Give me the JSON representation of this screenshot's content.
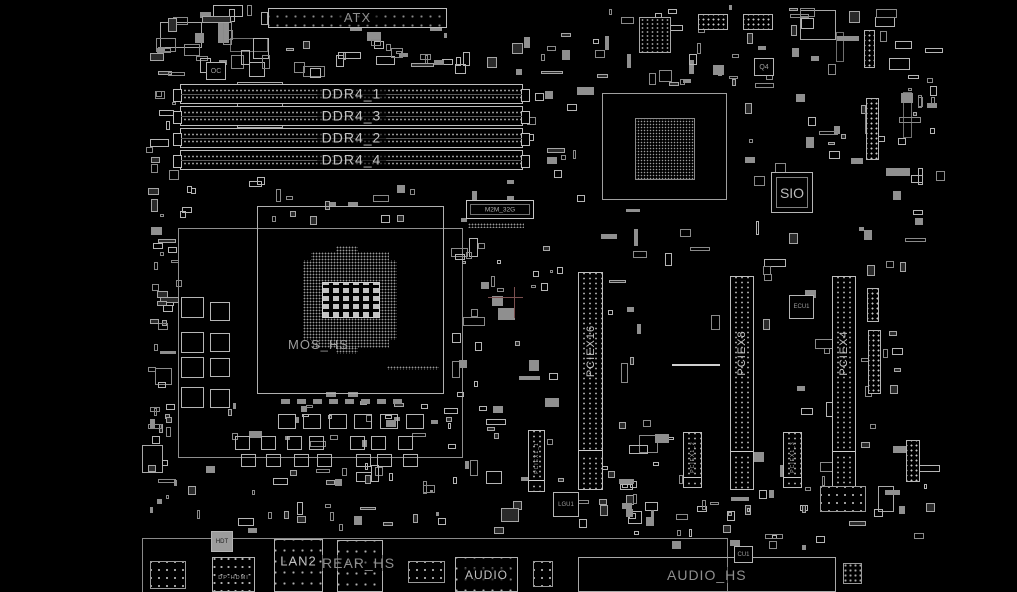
{
  "board": {
    "power_connector": {
      "label": "ATX"
    },
    "memory_slots": [
      {
        "label": "DDR4_1"
      },
      {
        "label": "DDR4_3"
      },
      {
        "label": "DDR4_2"
      },
      {
        "label": "DDR4_4"
      }
    ],
    "cpu_area": {
      "heatsink_label": "MOS_HS"
    },
    "m2_connector": {
      "label": "M2M_32G"
    },
    "pcie_slots": [
      {
        "label": "PCIEX16"
      },
      {
        "label": "PCIEX8"
      },
      {
        "label": "PCIEX4"
      }
    ],
    "pcie_x1_slots": [
      {
        "label": "PCIEX1_1"
      },
      {
        "label": "PCIEX1_2"
      },
      {
        "label": "PCIEX1_3"
      }
    ],
    "chips": {
      "sio": "SIO",
      "oc": "OC",
      "q4": "Q4",
      "ecu": "ECU1",
      "lgu": "LGU1",
      "cu": "CU1",
      "hdt": "HDT"
    },
    "rear_io": {
      "lan": "LAN2",
      "rear_heatsink": "REAR_HS",
      "display_out": "DP-HDMI",
      "audio_jack": "AUDIO"
    },
    "audio_heatsink": {
      "label": "AUDIO_HS"
    }
  }
}
